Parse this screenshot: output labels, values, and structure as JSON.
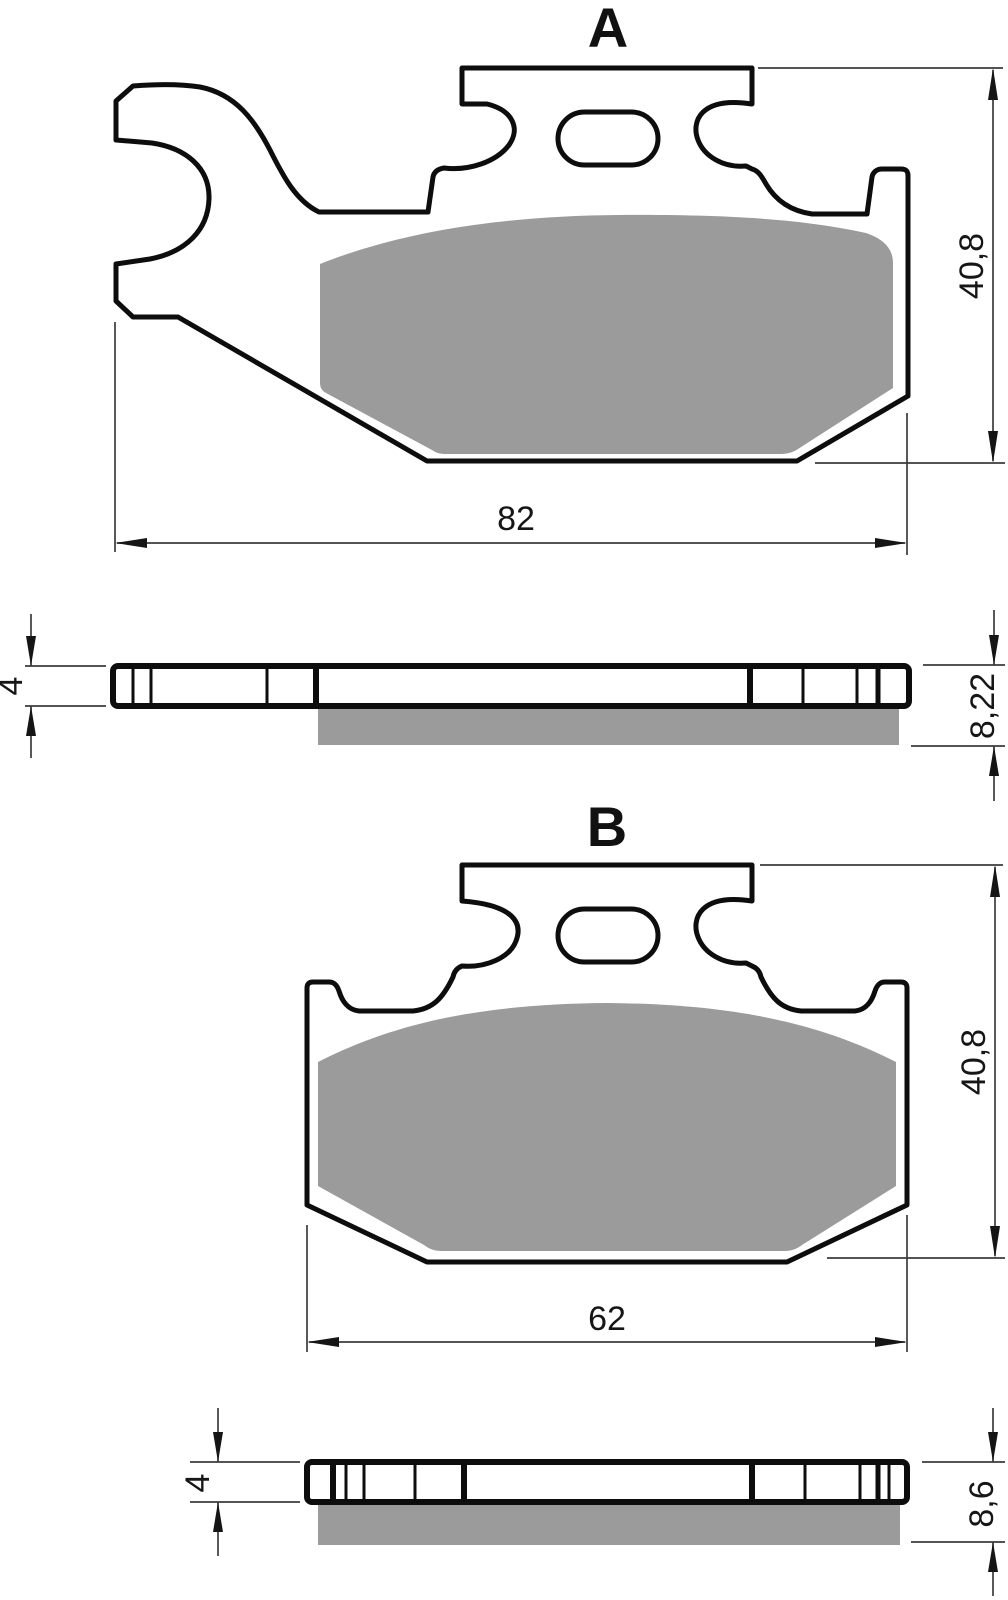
{
  "views": {
    "a": {
      "label": "A",
      "width_mm": "82",
      "height_mm": "40,8",
      "backing_thickness_mm": "4",
      "total_thickness_mm": "8,22"
    },
    "b": {
      "label": "B",
      "width_mm": "62",
      "height_mm": "40,8",
      "backing_thickness_mm": "4",
      "total_thickness_mm": "8,6"
    }
  },
  "colors": {
    "outline": "#0d0d0d",
    "friction_material": "#9b9b9b",
    "dimension_lines": "#3c3c3c",
    "background": "#ffffff"
  }
}
